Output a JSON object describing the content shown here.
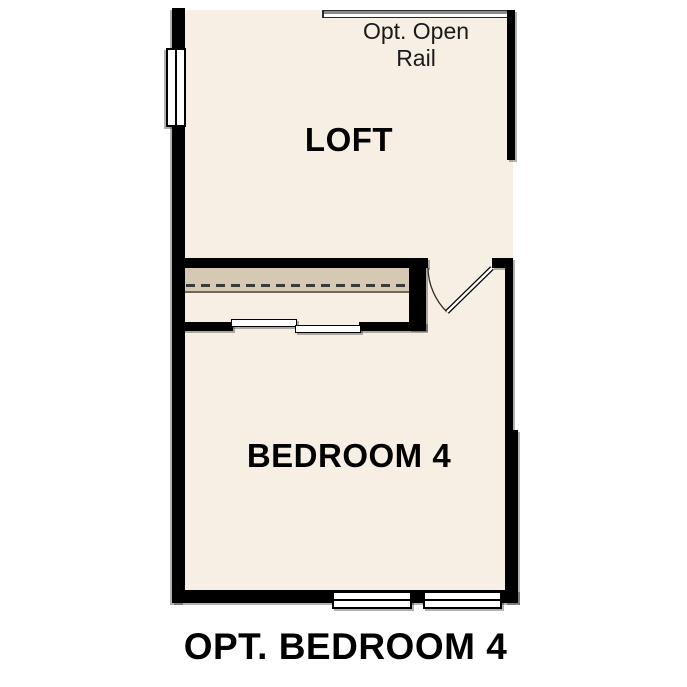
{
  "floorplan": {
    "rooms": [
      {
        "id": "loft",
        "label": "LOFT"
      },
      {
        "id": "bedroom-4",
        "label": "BEDROOM 4"
      }
    ],
    "annotations": [
      {
        "id": "open-rail",
        "label": "Opt. Open\nRail"
      }
    ],
    "caption": "OPT. BEDROOM 4",
    "symbols": [
      {
        "id": "open-rail-symbol",
        "type": "railing"
      },
      {
        "id": "window-left",
        "type": "window"
      },
      {
        "id": "window-bottom-1",
        "type": "window"
      },
      {
        "id": "window-bottom-2",
        "type": "window"
      },
      {
        "id": "closet-shelf",
        "type": "shelf-and-rod"
      },
      {
        "id": "closet-door-left-panel",
        "type": "bypass-door"
      },
      {
        "id": "closet-door-right-panel",
        "type": "bypass-door"
      },
      {
        "id": "swing-door",
        "type": "hinged-door"
      }
    ],
    "colors": {
      "floor": "#f7efe3",
      "wall": "#000000",
      "shelf": "#d5c9b4",
      "shelf_edge": "#6f6656",
      "rail": "#8a8a8a",
      "background": "#ffffff",
      "text": "#000000"
    }
  }
}
